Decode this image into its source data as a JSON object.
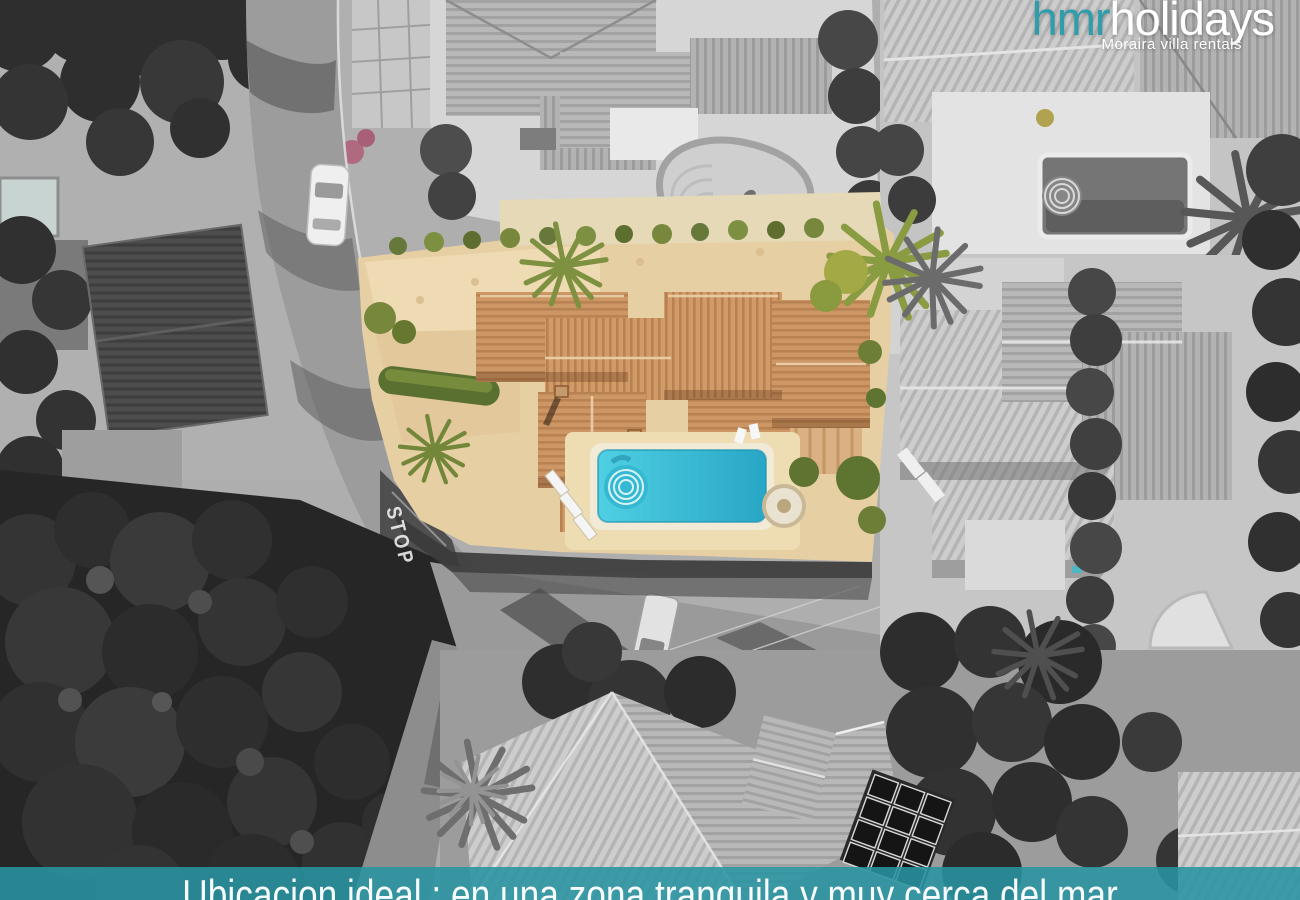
{
  "branding": {
    "logo_primary": "hmr",
    "logo_secondary": "holidays",
    "tagline": "Moraira villa rentals",
    "logo_primary_color": "#2f9dac",
    "logo_secondary_color": "#ffffff"
  },
  "caption_banner": {
    "text": "Ubicacion ideal : en una zona tranquila y muy cerca del mar",
    "background_color": "#2994a3",
    "text_color": "#ffffff"
  },
  "road_marking": {
    "stop_label": "STOP"
  },
  "palette": {
    "pool_water": "#3cc4d8",
    "roof_tiles": "#c99566",
    "sand_ground": "#e7cfa4",
    "vegetation_green": "#7e9140",
    "photo_grayscale": "#9b9b9b",
    "banner_teal": "#2994a3"
  }
}
